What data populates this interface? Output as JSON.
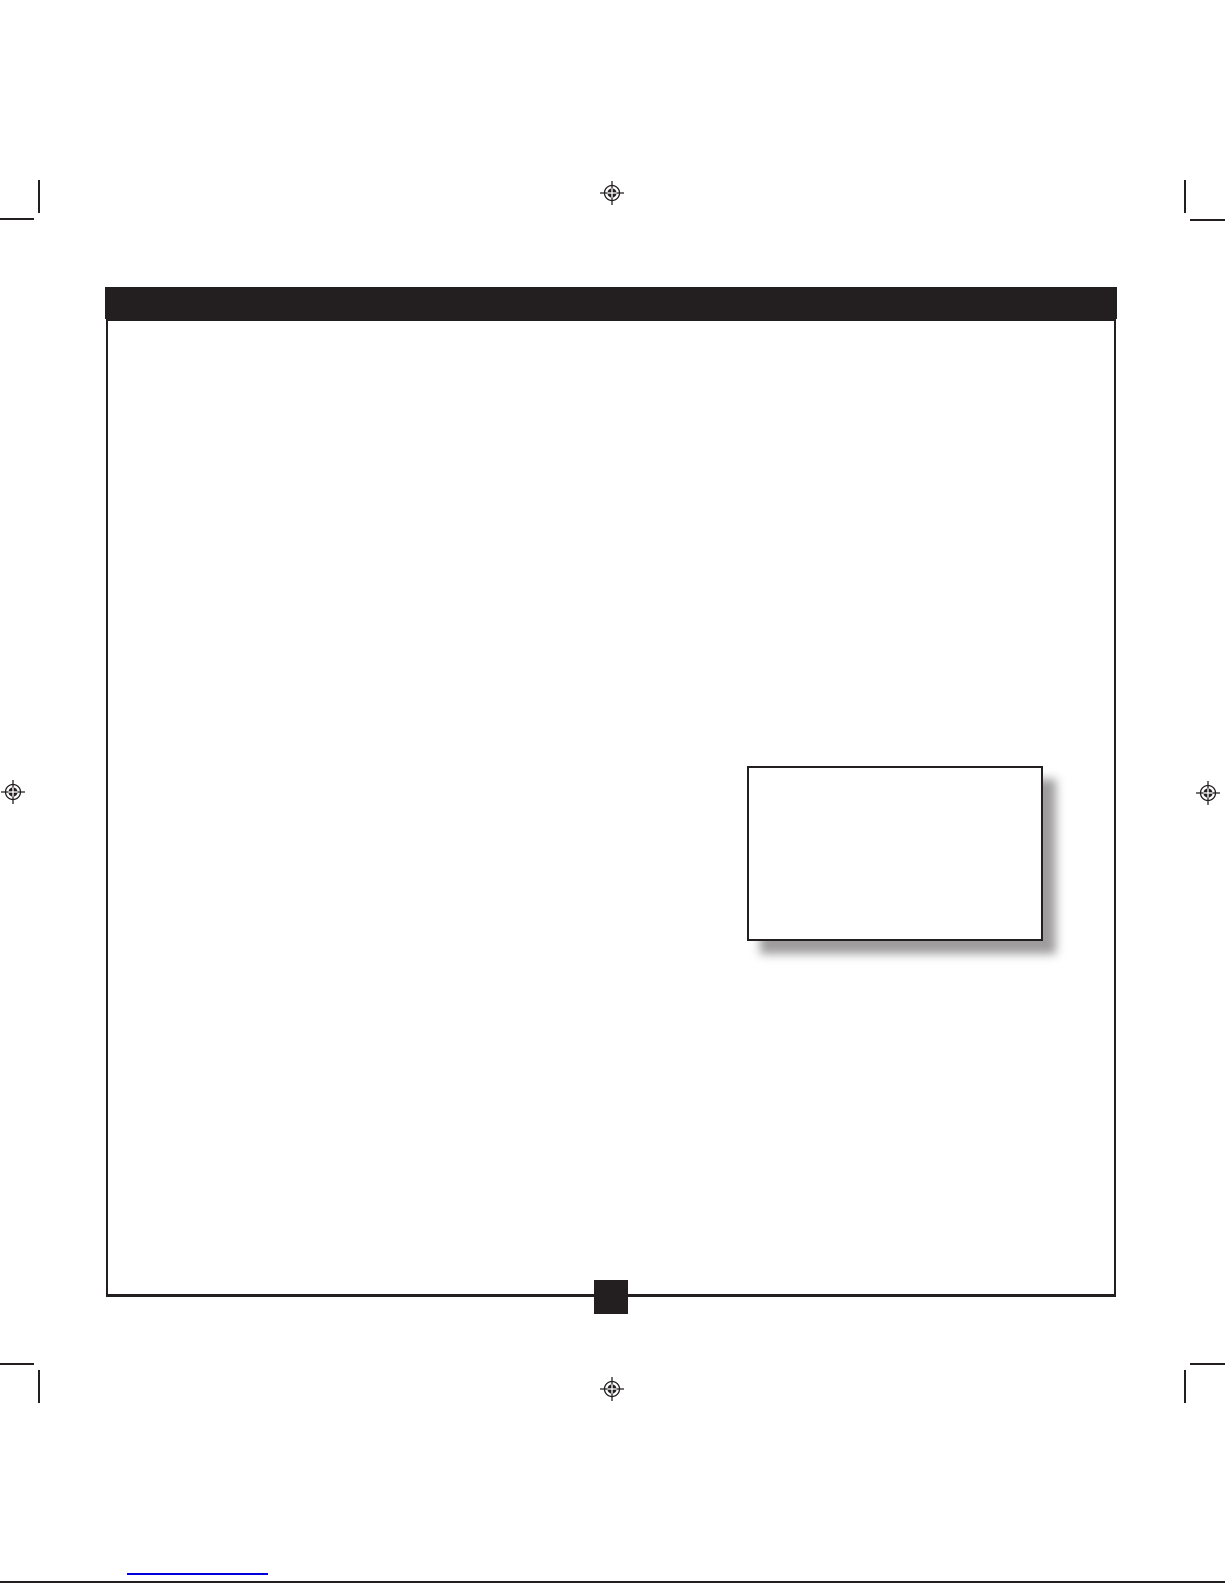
{
  "colors": {
    "ink": "#231f20",
    "paper": "#ffffff",
    "link_blue": "#0000dd",
    "box_shadow": "rgba(40,36,37,0.45)"
  },
  "header_bar": {
    "title": ""
  },
  "page": {
    "body_text": "",
    "page_number": ""
  },
  "callout_box": {
    "content": ""
  },
  "footer": {
    "link_text": ""
  },
  "print_marks": {
    "registration_marks": [
      {
        "name": "registration-mark",
        "position": "top-center"
      },
      {
        "name": "registration-mark",
        "position": "left-middle"
      },
      {
        "name": "registration-mark",
        "position": "right-middle"
      },
      {
        "name": "registration-mark",
        "position": "bottom-center"
      }
    ],
    "crop_marks": [
      {
        "name": "crop-mark",
        "position": "top-left"
      },
      {
        "name": "crop-mark",
        "position": "top-right"
      },
      {
        "name": "crop-mark",
        "position": "bottom-left"
      },
      {
        "name": "crop-mark",
        "position": "bottom-right"
      }
    ]
  }
}
